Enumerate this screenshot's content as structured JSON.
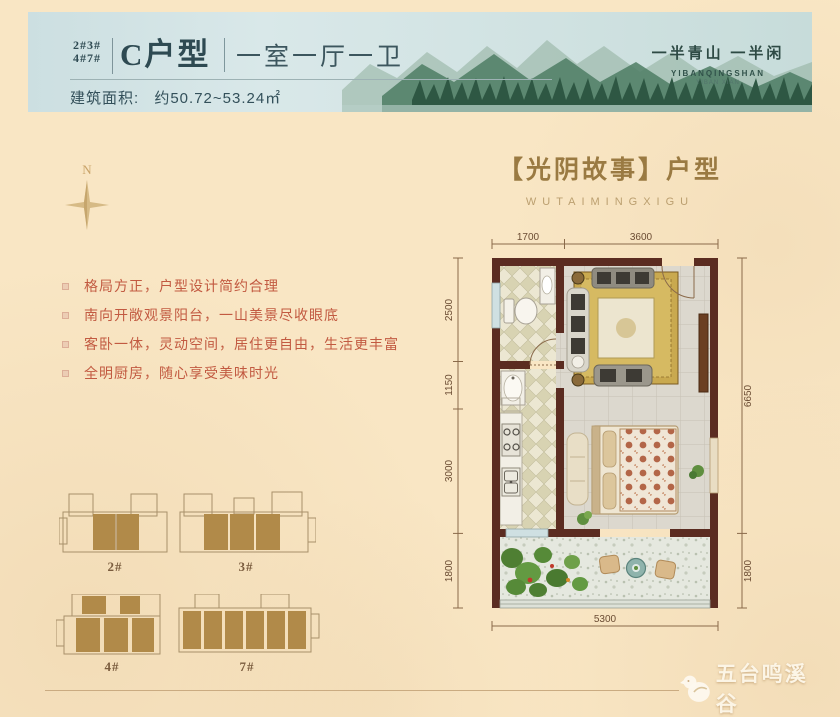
{
  "header": {
    "building_nums_line1": "2#3#",
    "building_nums_line2": "4#7#",
    "unit_type": "C户型",
    "layout_desc": "一室一厅一卫",
    "area_label": "建筑面积:",
    "area_value": "约50.72~53.24㎡",
    "brand_slogan": "一半青山 一半闲",
    "brand_en": "YIBANQINGSHAN",
    "brand_en_sub": "YIBAN XIAN"
  },
  "compass": {
    "north_label": "N"
  },
  "plan_title": {
    "main": "【光阴故事】户型",
    "sub": "WUTAIMINGXIGU"
  },
  "features": [
    "格局方正，户型设计简约合理",
    "南向开敞观景阳台，一山美景尽收眼底",
    "客卧一体，灵动空间，居住更自由，生活更丰富",
    "全明厨房，随心享受美味时光"
  ],
  "floorplan": {
    "dims_top": [
      "1700",
      "3600"
    ],
    "dims_left": [
      "2500",
      "1150",
      "3000",
      "1800"
    ],
    "dims_right": [
      "6650",
      "1800"
    ],
    "dims_bottom": [
      "5300"
    ]
  },
  "buildings": [
    {
      "label": "2#"
    },
    {
      "label": "3#"
    },
    {
      "label": "4#"
    },
    {
      "label": "7#"
    }
  ],
  "footer": {
    "brand_cn": "五台鸣溪谷"
  },
  "colors": {
    "wall_brown": "#5b2c21",
    "feature_red": "#c25a41",
    "title_gold": "#9a7a42",
    "header_teal": "#2e4a52",
    "block_brown": "#b18a49",
    "cream_bg": "#f9e6c4"
  }
}
